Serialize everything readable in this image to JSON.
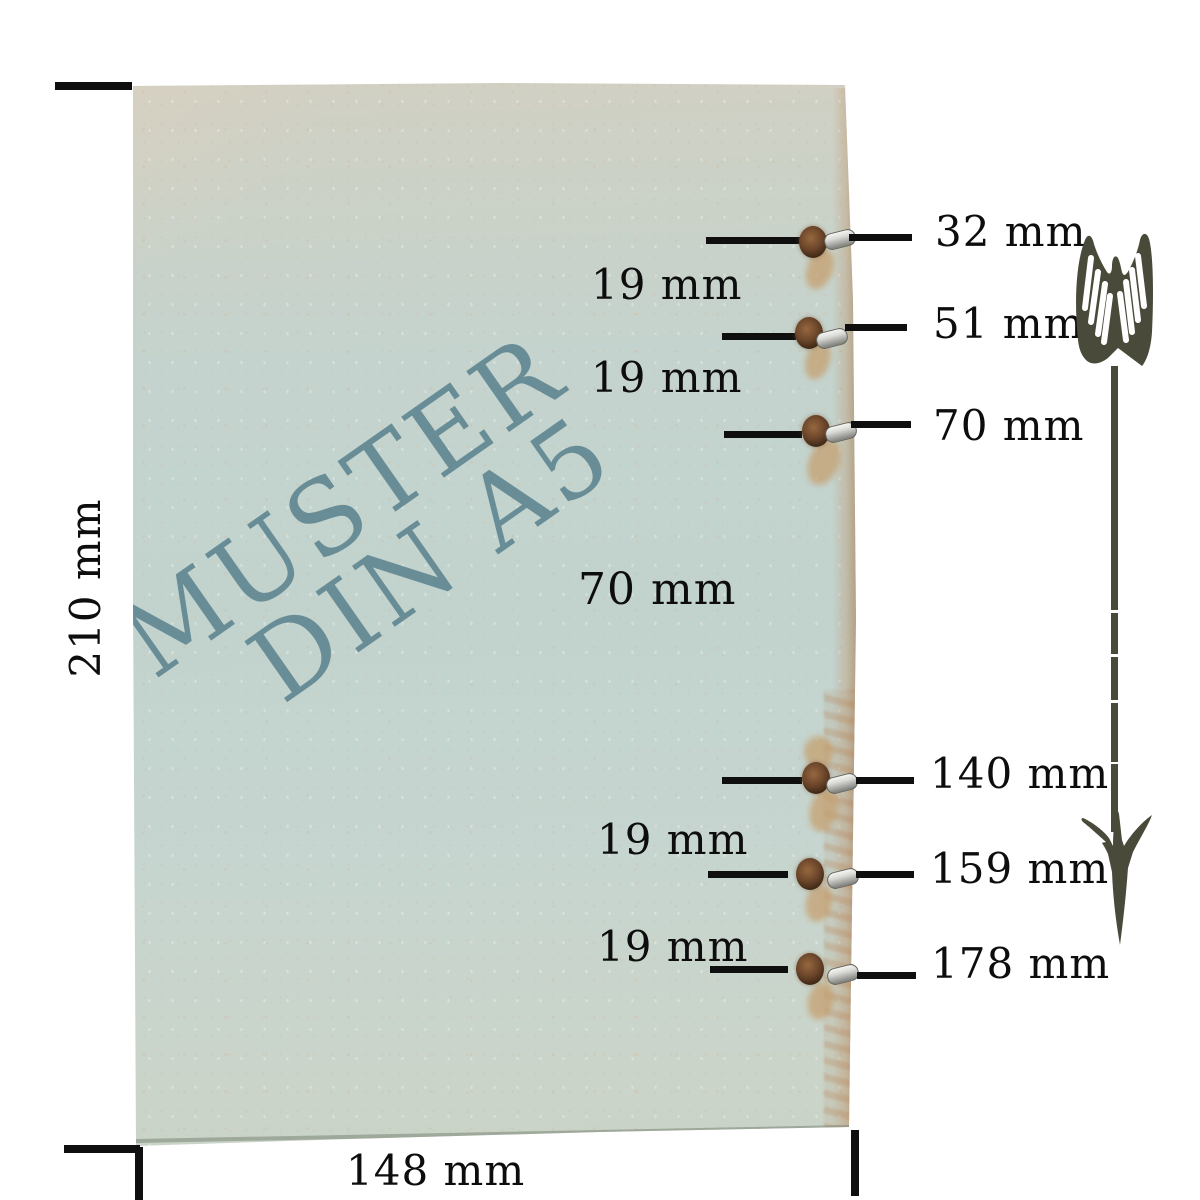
{
  "figure": {
    "watermark_line1": "MUSTER",
    "watermark_line2": "DIN A5",
    "height_label": "210 mm",
    "width_label": "148 mm"
  },
  "holes": [
    {
      "label": "32 mm"
    },
    {
      "label": "51 mm"
    },
    {
      "label": "70 mm"
    },
    {
      "label": "140 mm"
    },
    {
      "label": "159 mm"
    },
    {
      "label": "178 mm"
    }
  ],
  "spacings": [
    {
      "label": "19 mm"
    },
    {
      "label": "19 mm"
    },
    {
      "label": "70 mm"
    },
    {
      "label": "19 mm"
    },
    {
      "label": "19 mm"
    }
  ],
  "colors": {
    "paper_top_beige": "#d6cfbf",
    "paper_teal": "#c2d3ce",
    "paper_tan_corner": "#d8b78a",
    "watermark_teal": "#547e8a",
    "dimension_ink": "#0d0d0d",
    "arrow_olive": "#4a4a3a",
    "eyelet_silver": "#c9c9c6",
    "hole_brown": "#6b452a"
  },
  "icons": {
    "arrow": "down-arrow-icon"
  }
}
